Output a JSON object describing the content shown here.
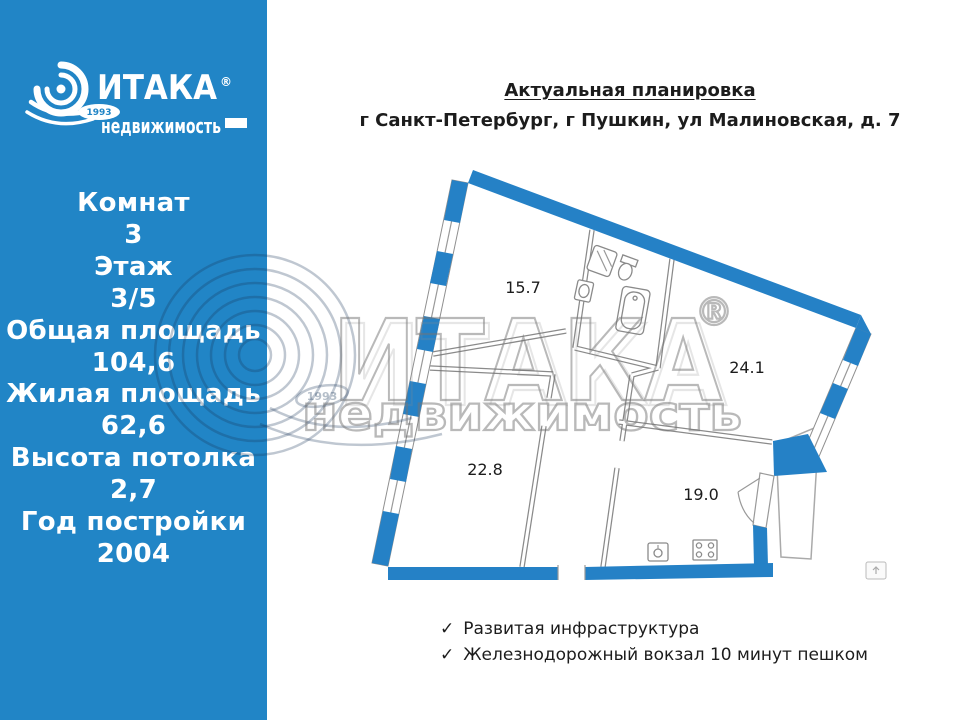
{
  "sidebar": {
    "bg_color": "#2185c6",
    "logo": {
      "brand": "ИТАКА",
      "reg": "®",
      "sub": "недвижимость",
      "year": "1993"
    },
    "stats": [
      {
        "label": "Комнат",
        "value": "3"
      },
      {
        "label": "Этаж",
        "value": "3/5"
      },
      {
        "label": "Общая площадь",
        "value": "104,6"
      },
      {
        "label": "Жилая площадь",
        "value": "62,6"
      },
      {
        "label": "Высота потолка",
        "value": "2,7"
      },
      {
        "label": "Год постройки",
        "value": "2004"
      }
    ]
  },
  "header": {
    "title": "Актуальная планировка",
    "address": "г Санкт-Петербург, г Пушкин, ул Малиновская, д. 7"
  },
  "floorplan": {
    "wall_color": "#2581c6",
    "rooms": [
      {
        "label": "15.7"
      },
      {
        "label": "24.1"
      },
      {
        "label": "22.8"
      },
      {
        "label": "19.0"
      }
    ]
  },
  "watermark": {
    "brand": "ИТАКА",
    "reg": "®",
    "sub": "недвижимость",
    "year": "1993"
  },
  "features": {
    "check": "✓",
    "items": [
      "Развитая инфраструктура",
      "Железнодорожный вокзал 10 минут пешком"
    ]
  }
}
